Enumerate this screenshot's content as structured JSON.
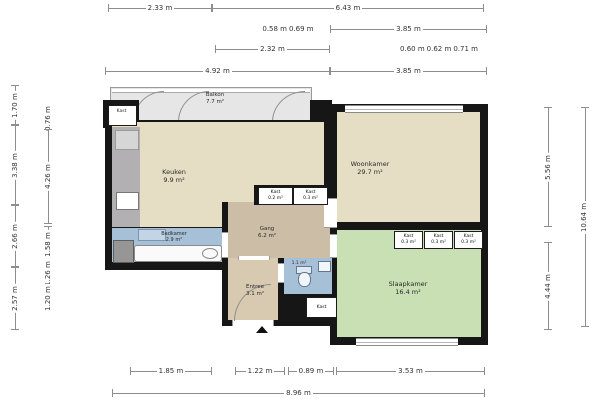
{
  "rooms": {
    "balkon": {
      "name": "Balkon",
      "area": "7.7 m²"
    },
    "kast_top_left": {
      "name": "Kast"
    },
    "keuken": {
      "name": "Keuken",
      "area": "9.9 m²"
    },
    "woonkamer": {
      "name": "Woonkamer",
      "area": "29.7 m²"
    },
    "kast_gang_1": {
      "name": "Kast",
      "area": "0.2 m²"
    },
    "kast_gang_2": {
      "name": "Kast",
      "area": "0.3 m²"
    },
    "gang": {
      "name": "Gang",
      "area": "6.2 m²"
    },
    "badkamer": {
      "name": "Badkamer",
      "area": "2.9 m²"
    },
    "toilet": {
      "area": "1.1 m²"
    },
    "entree": {
      "name": "Entree",
      "area": "3.1 m²"
    },
    "kast_entree": {
      "name": "Kast"
    },
    "slaapkamer": {
      "name": "Slaapkamer",
      "area": "16.4 m²"
    },
    "kast_slaap_1": {
      "name": "Kast",
      "area": "0.3 m²"
    },
    "kast_slaap_2": {
      "name": "Kast",
      "area": "0.3 m²"
    },
    "kast_slaap_3": {
      "name": "Kast",
      "area": "0.3 m²"
    }
  },
  "measurements": {
    "top": [
      "2.33 m",
      "6.43 m",
      "0.58 m",
      "0.69 m",
      "3.85 m",
      "2.32 m",
      "0.60 m",
      "0.62 m",
      "0.71 m",
      "4.92 m",
      "3.85 m"
    ],
    "bottom": [
      "1.85 m",
      "1.22 m",
      "0.89 m",
      "3.53 m",
      "8.96 m"
    ],
    "left_outer": [
      "1.70 m",
      "3.38 m",
      "2.66 m",
      "2.57 m"
    ],
    "left_inner": [
      "0.76 m",
      "4.26 m",
      "1.58 m",
      "1.26 m",
      "1.20 m"
    ],
    "right_inner": [
      "5.56 m",
      "4.44 m"
    ],
    "right_outer": [
      "10.64 m"
    ]
  },
  "colors": {
    "wall": "#161616",
    "living": "#e6dec4",
    "hall": "#cbbda6",
    "entry": "#d7cab1",
    "bath": "#a6c0d8",
    "bedroom": "#c9dfb4",
    "balcony": "#e6e6e6",
    "closet": "#ffffff"
  }
}
